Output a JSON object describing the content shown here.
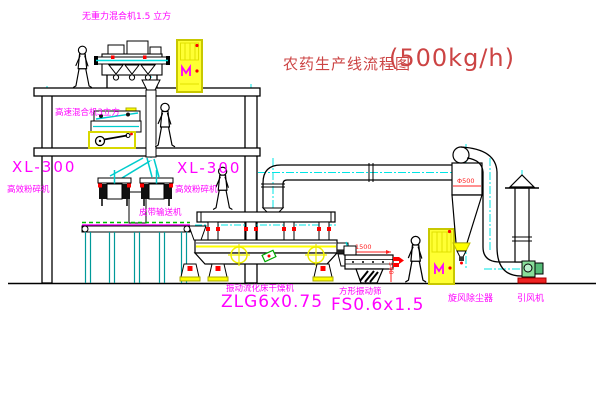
{
  "title": {
    "text": "农药生产线流程图",
    "capacity": "(500kg/h)"
  },
  "labels": {
    "gravity_free_mixer": "无重力混合机1.5 立方",
    "high_speed_mixer": "高速混合机3立方",
    "mill_left_model": "XL-300",
    "mill_left_name": "高效粉碎机",
    "mill_center_model": "XL-300",
    "mill_center_name": "高效粉碎机",
    "belt_conveyor": "皮带输送机",
    "dryer_name": "振动流化床干燥机",
    "dryer_model": "ZLG6x0.75",
    "screen_name": "方形振动筛",
    "screen_model": "FS0.6x1.5",
    "cyclone": "旋风除尘器",
    "fan": "引风机"
  },
  "dimensions": {
    "screen_length": "1500",
    "screen_discharge_height": "540",
    "cyclone_diameter": "Φ500"
  },
  "colors": {
    "label_magenta": "#ff00ff",
    "title_red": "#cc4444",
    "dimension_red": "#ff2222",
    "centerline_cyan": "#00e5e5",
    "equipment_yellow": "#ffff33",
    "line_black": "#000000"
  }
}
